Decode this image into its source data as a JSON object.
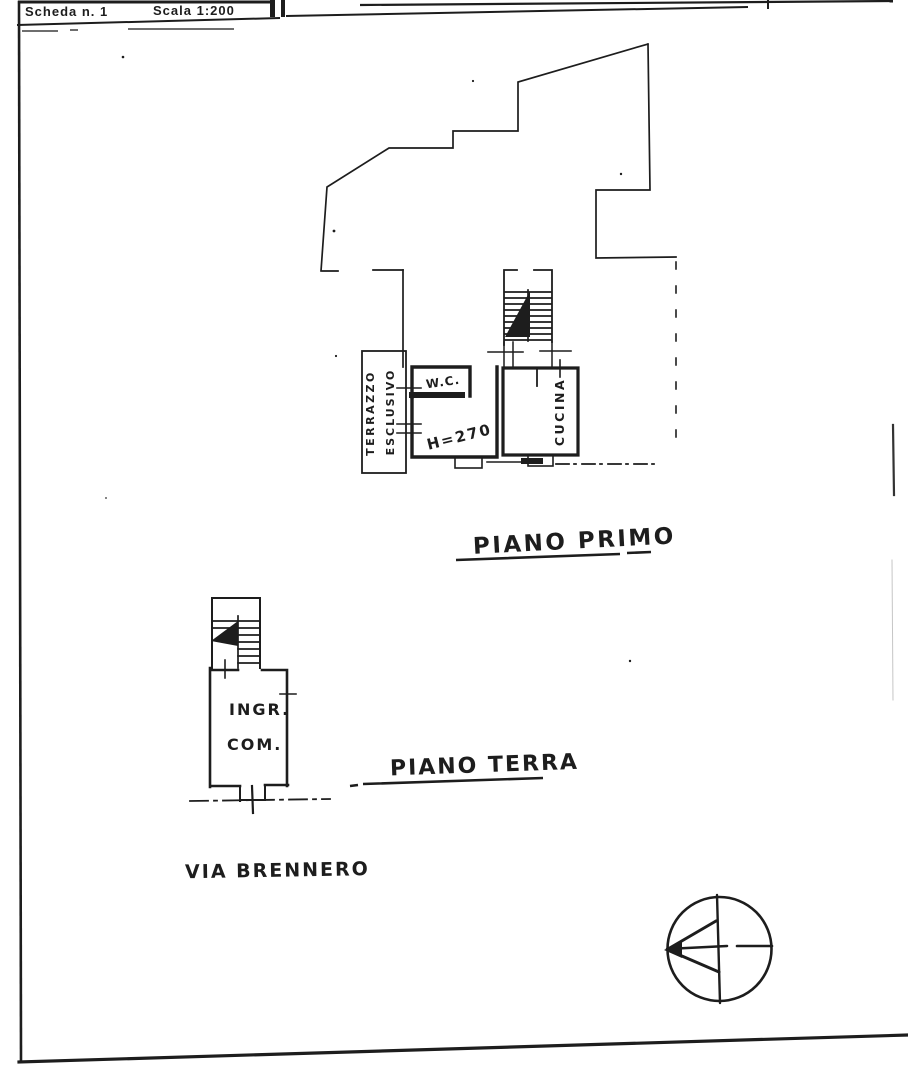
{
  "header": {
    "scheda_label": "Scheda n. 1",
    "scala_label": "Scala 1:200"
  },
  "first_floor": {
    "caption": "PIANO PRIMO",
    "terrazzo_label_line1": "TERRAZZO",
    "terrazzo_label_line2": "ESCLUSIVO",
    "wc_label": "W.C.",
    "height_label": "H=270",
    "kitchen_label": "CUCINA"
  },
  "ground_floor": {
    "caption": "PIANO TERRA",
    "entrance_label_line1": "INGR.",
    "entrance_label_line2": "COM.",
    "street_label": "VIA BRENNERO"
  },
  "colors": {
    "ink": "#1d1d1d",
    "paper": "#ffffff"
  }
}
